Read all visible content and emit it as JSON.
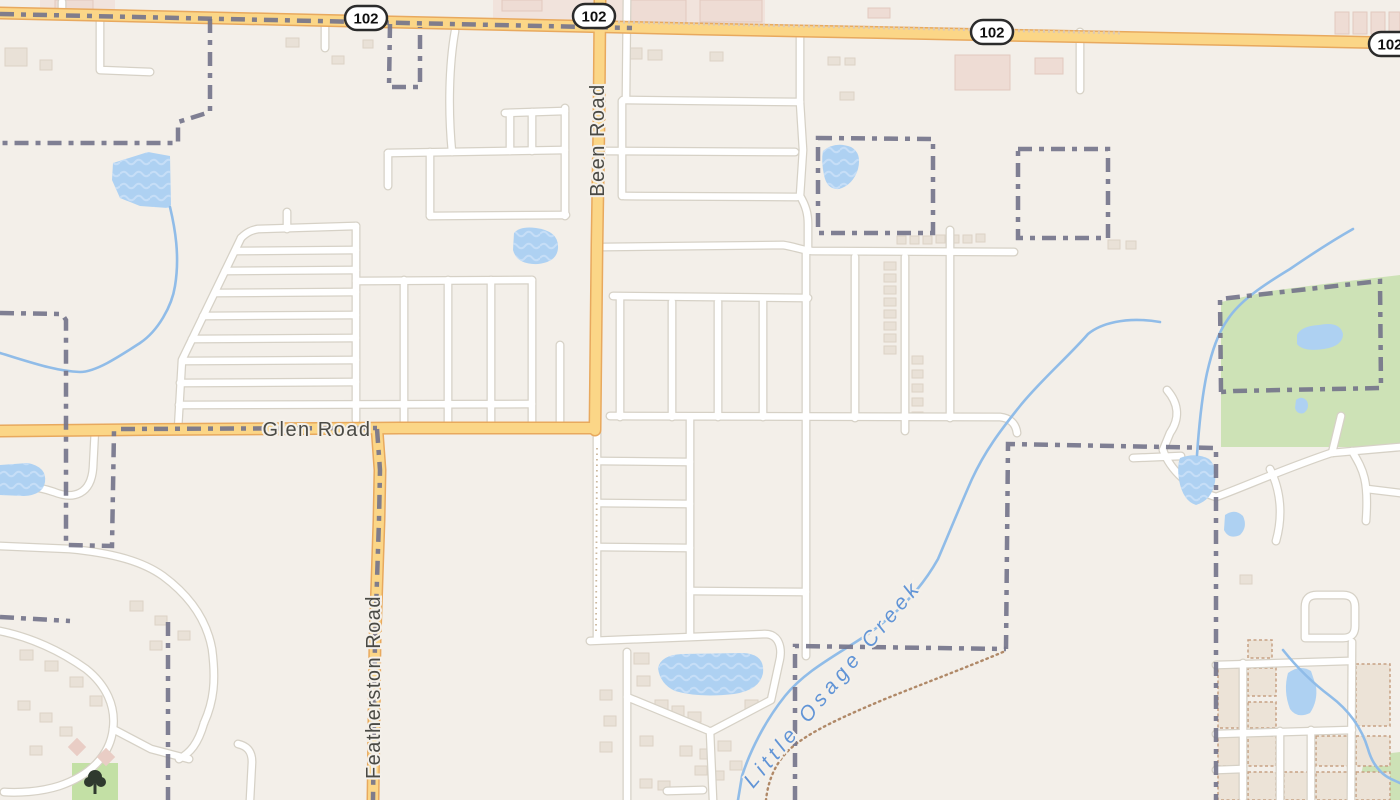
{
  "map": {
    "kind": "street-map",
    "shields": [
      {
        "label": "102"
      },
      {
        "label": "102"
      },
      {
        "label": "102"
      },
      {
        "label": "102"
      }
    ],
    "road_labels": {
      "been": "Been Road",
      "glen": "Glen Road",
      "featherston": "Featherston Road"
    },
    "water_labels": {
      "creek": "Little Osage Creek"
    },
    "colors": {
      "background": "#f3efe9",
      "primary_road_fill": "#fbd687",
      "primary_road_casing": "#e8a95e",
      "minor_road_fill": "#ffffff",
      "minor_road_casing": "#d6d1c6",
      "water": "#aed1f2",
      "water_wave": "#c6def7",
      "creek": "#90bce8",
      "water_label": "#6194d6",
      "boundary": "#75758b",
      "green_area": "#cde2b6",
      "park_green": "#c3e0a5",
      "building": "#e9e1d7",
      "building_pink": "#eedcd4",
      "road_label": "#4a4a45",
      "track": "#b08968"
    }
  }
}
